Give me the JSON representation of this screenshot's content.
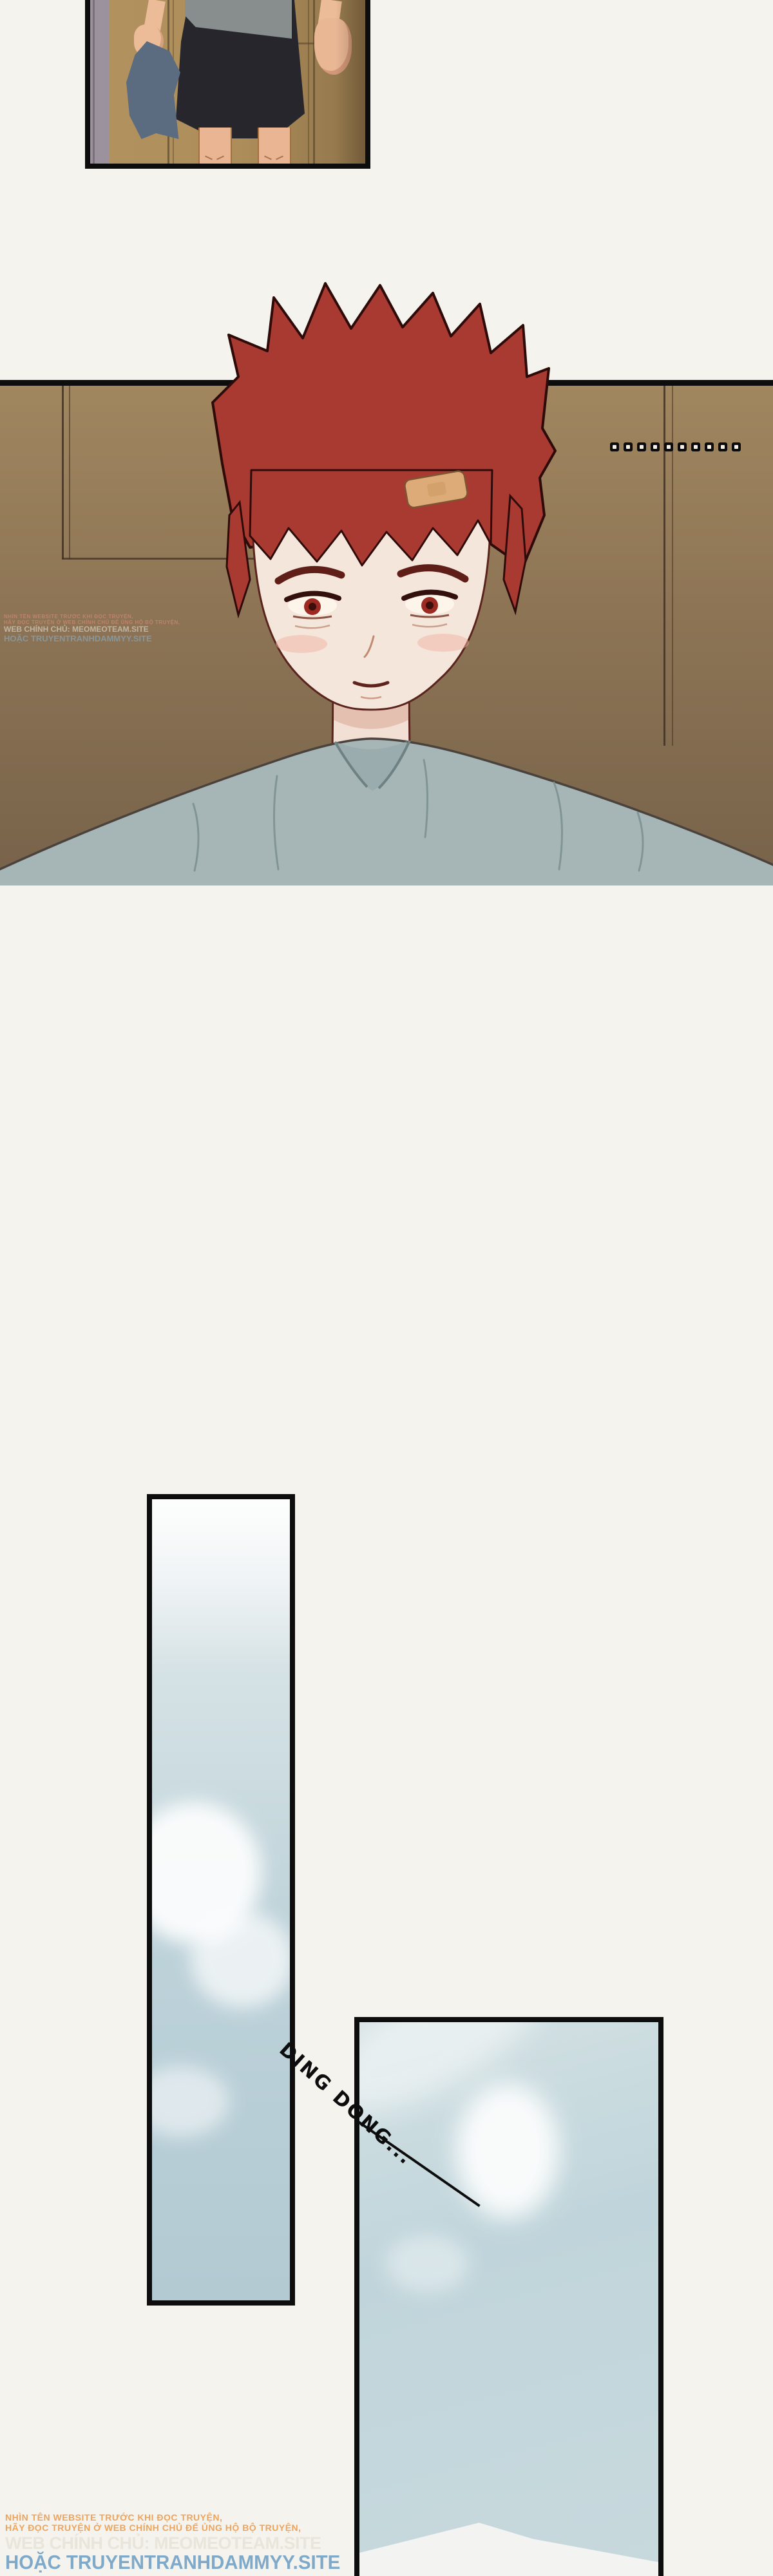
{
  "comic": {
    "sfx_ding_dong": "DING DONG...",
    "ellipsis_dot_count": 10,
    "watermark_small": {
      "line1": "NHÌN TÊN WEBSITE TRƯỚC KHI ĐỌC TRUYỆN,",
      "line2": "HÃY ĐỌC TRUYỆN Ở WEB CHÍNH CHỦ ĐỂ ỦNG HỘ BỘ TRUYỆN,",
      "line3": "WEB CHÍNH CHỦ: MEOMEOTEAM.SITE",
      "line4": "HOẶC TRUYENTRANHDAMMYY.SITE"
    },
    "watermark_large": {
      "line1": "NHÌN TÊN WEBSITE TRƯỚC KHI ĐỌC TRUYỆN,",
      "line2": "HÃY ĐỌC TRUYỆN Ở WEB CHÍNH CHỦ ĐỂ ỦNG HỘ BỘ TRUYỆN,",
      "line3": "WEB CHÍNH CHỦ: MEOMEOTEAM.SITE",
      "line4": "HOẶC TRUYENTRANHDAMMYY.SITE"
    },
    "colors": {
      "page_bg": "#f5f3ee",
      "panel_border": "#0d0d0d",
      "wall_brown": "#8d7455",
      "wood_brown": "#ad8d5a",
      "hair_red": "#a83a32",
      "skin": "#f5e6dc",
      "shirt_gray_blue": "#a6b6b6",
      "shorts_black": "#26262c",
      "towel_slate": "#5b6b80",
      "sky_blue": "#bdd2d9",
      "watermark_orange": "#eda45c",
      "watermark_gray": "#e8e5da",
      "watermark_blue": "#7fa9c9",
      "sfx_black": "#0d0d0d"
    }
  }
}
